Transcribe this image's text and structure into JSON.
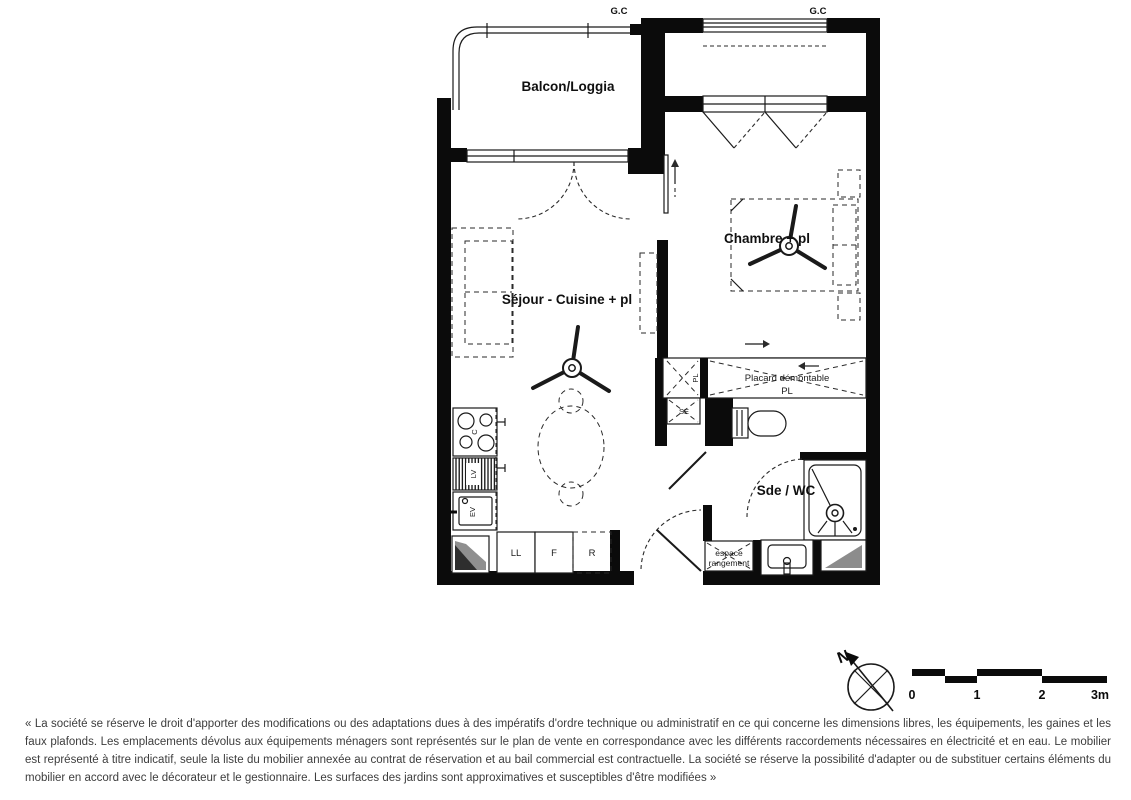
{
  "plan": {
    "labels": {
      "gc_left": "G.C",
      "gc_right": "G.C",
      "balcony": "Balcon/Loggia",
      "living_kitchen": "Séjour - Cuisine + pl",
      "bedroom": "Chambre + pl",
      "closet_line1": "Placard démontable",
      "closet_line2": "PL",
      "small_closet": "PL",
      "se_unit": "SE",
      "bathroom": "Sde / WC",
      "storage_line1": "espace",
      "storage_line2": "rangement",
      "cooktop": "C",
      "dishwasher": "LV",
      "sink": "EV",
      "washing_machine": "LL",
      "oven": "F",
      "fridge": "R"
    }
  },
  "compass": {
    "north_label": "N"
  },
  "scale_bar": {
    "ticks": [
      "0",
      "1",
      "2",
      "3m"
    ]
  },
  "disclaimer": "« La société se réserve le droit d'apporter des modifications ou des adaptations dues à des impératifs d'ordre technique ou administratif en ce qui concerne les dimensions libres, les équipements, les gaines et les faux plafonds. Les emplacements dévolus aux équipements ménagers sont représentés sur le plan de vente en correspondance avec les différents raccordements nécessaires en électricité et en eau. Le mobilier est représenté à titre indicatif, seule la liste du mobilier annexée au contrat de réservation et au bail commercial est contractuelle. La société se réserve la possibilité d'adapter ou de substituer certains éléments du mobilier en accord avec le décorateur et le gestionnaire. Les surfaces des jardins sont approximatives et susceptibles d'être modifiées »"
}
